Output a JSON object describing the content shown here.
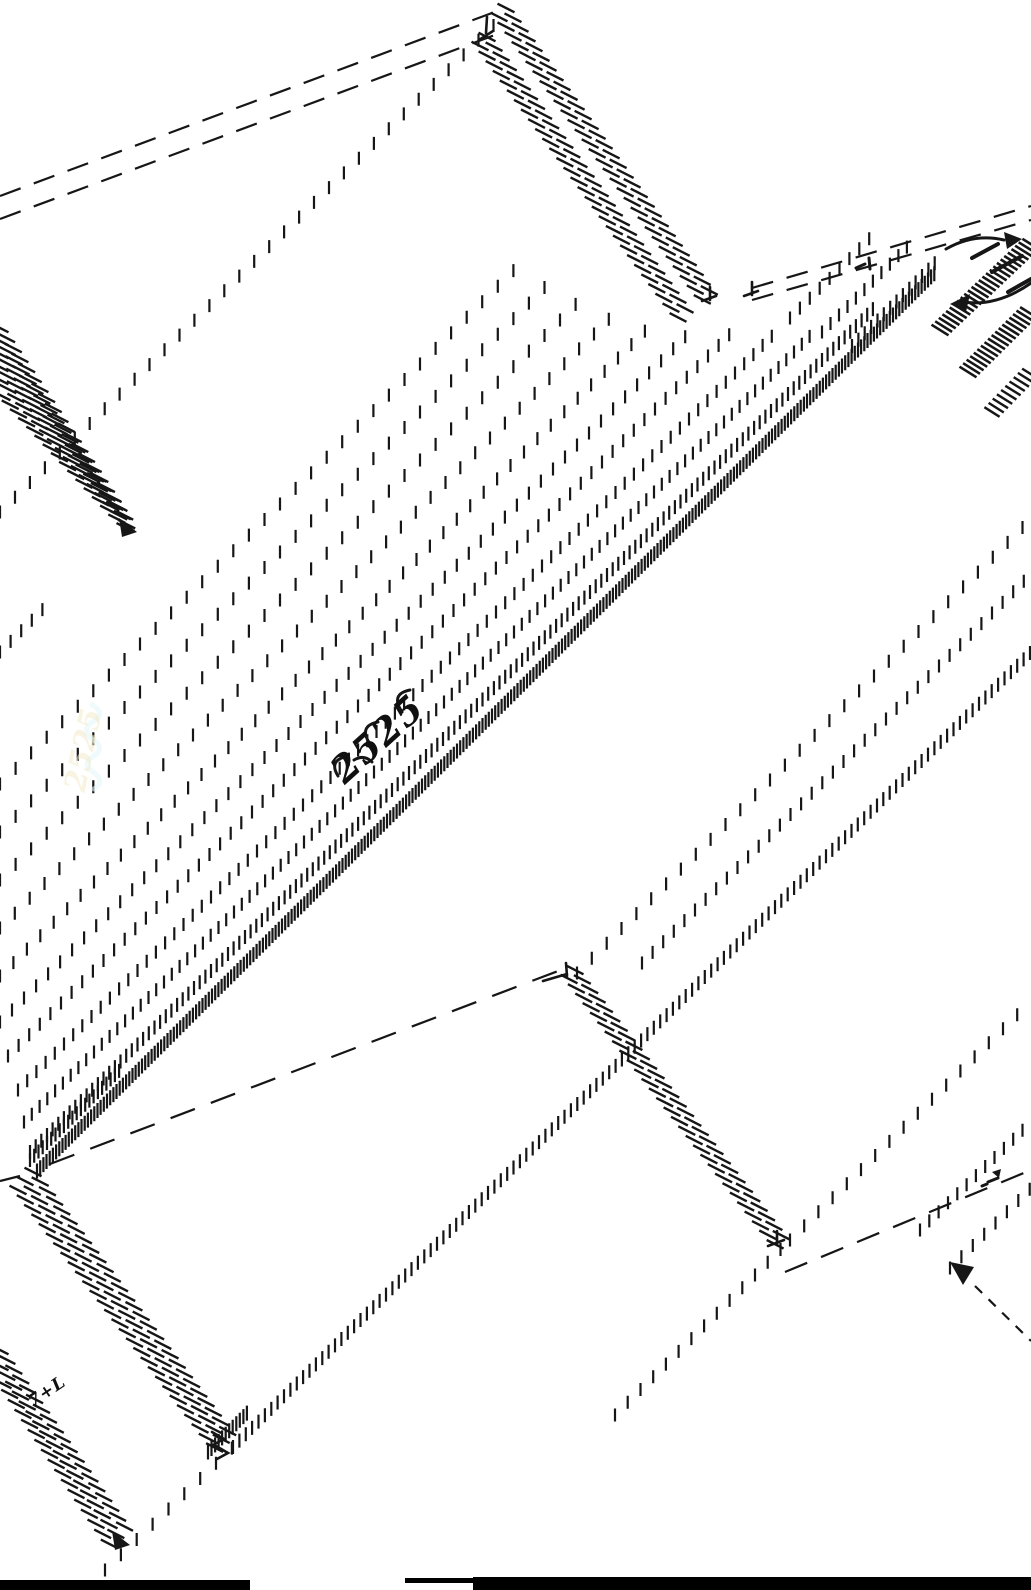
{
  "drawing": {
    "ink": "#161616",
    "background": "#ffffff",
    "canvas": {
      "width": 1031,
      "height": 1590
    },
    "annotations": [
      {
        "id": "center-scribble",
        "text": "2525",
        "x": 386,
        "y": 748,
        "rot": -42,
        "size": 37,
        "ls": 2,
        "color": "#101010",
        "opacity": 1
      },
      {
        "id": "bottom-left-scribble",
        "text": "7+L",
        "x": 50,
        "y": 1396,
        "rot": -34,
        "size": 17,
        "ls": 1,
        "color": "#101010",
        "opacity": 1
      },
      {
        "id": "ghost-scribble",
        "text": "2525",
        "x": 93,
        "y": 752,
        "rot": -78,
        "size": 30,
        "ls": 0,
        "color": "#f3ecca",
        "opacity": 0.55
      }
    ],
    "bars": [
      {
        "id": "bottom-left-bar",
        "x": 0,
        "y": 1580,
        "w": 250,
        "h": 10
      },
      {
        "id": "bottom-strip",
        "x": 405,
        "y": 1578,
        "w": 68,
        "h": 5
      },
      {
        "id": "bottom-right-bar",
        "x": 473,
        "y": 1577,
        "w": 558,
        "h": 13
      }
    ],
    "primitives": [
      {
        "t": "dash",
        "n": "roof-top-dash-a",
        "p": [
          0,
          196,
          500,
          10
        ],
        "da": [
          22,
          14
        ]
      },
      {
        "t": "dash",
        "n": "roof-top-dash-b",
        "p": [
          0,
          219,
          503,
          32
        ],
        "da": [
          22,
          14
        ]
      },
      {
        "t": "dash",
        "n": "wall-top-dash-a",
        "p": [
          752,
          288,
          1031,
          206
        ],
        "da": [
          22,
          14
        ]
      },
      {
        "t": "dash",
        "n": "wall-top-dash-b",
        "p": [
          752,
          300,
          1031,
          220
        ],
        "da": [
          22,
          14
        ]
      },
      {
        "t": "dash",
        "n": "valley-dash",
        "p": [
          50,
          1164,
          566,
          968
        ],
        "da": [
          26,
          17
        ]
      },
      {
        "t": "dash",
        "n": "bottom-right-dash",
        "p": [
          785,
          1272,
          1031,
          1170
        ],
        "da": [
          24,
          15
        ]
      },
      {
        "t": "dash",
        "n": "arrow-leader-dash",
        "p": [
          975,
          1286,
          1031,
          1341
        ],
        "da": [
          10,
          9
        ]
      },
      {
        "t": "solid",
        "n": "tip-left-line",
        "p": [
          0,
          1181,
          20,
          1176
        ]
      },
      {
        "t": "stair",
        "n": "ridge-band-a1",
        "p": [
          506,
          8,
          714,
          297
        ]
      },
      {
        "t": "stair",
        "n": "ridge-band-a2",
        "p": [
          499,
          17,
          707,
          306
        ]
      },
      {
        "t": "stair",
        "n": "ridge-band-b1",
        "p": [
          487,
          37,
          692,
          318
        ]
      },
      {
        "t": "stair",
        "n": "ridge-band-b2",
        "p": [
          480,
          46,
          685,
          327
        ]
      },
      {
        "t": "stair",
        "n": "left-edge-band-1",
        "p": [
          0,
          328,
          118,
          505
        ]
      },
      {
        "t": "stair",
        "n": "left-edge-band-2",
        "p": [
          0,
          341,
          122,
          511
        ]
      },
      {
        "t": "stair",
        "n": "left-edge-band-3",
        "p": [
          0,
          354,
          126,
          517
        ]
      },
      {
        "t": "stair",
        "n": "left-edge-band-4",
        "p": [
          0,
          367,
          129,
          523
        ]
      },
      {
        "t": "stair",
        "n": "left-edge-band-5",
        "p": [
          0,
          380,
          131,
          529
        ]
      },
      {
        "t": "stair",
        "n": "left-edge-band-6",
        "p": [
          2,
          396,
          133,
          536
        ]
      },
      {
        "t": "stair",
        "n": "tip-band-1",
        "p": [
          33,
          1172,
          233,
          1438
        ]
      },
      {
        "t": "stair",
        "n": "tip-band-2",
        "p": [
          25,
          1181,
          226,
          1445
        ]
      },
      {
        "t": "stair",
        "n": "tip-band-3",
        "p": [
          18,
          1190,
          218,
          1452
        ]
      },
      {
        "t": "stair",
        "n": "low-left-band-1",
        "p": [
          0,
          1350,
          127,
          1530
        ]
      },
      {
        "t": "stair",
        "n": "low-left-band-2",
        "p": [
          0,
          1366,
          120,
          1540
        ]
      },
      {
        "t": "stair",
        "n": "low-left-band-3",
        "p": [
          3,
          1384,
          112,
          1548
        ]
      },
      {
        "t": "stair",
        "n": "v-right-band-1",
        "p": [
          575,
          970,
          785,
          1240
        ]
      },
      {
        "t": "stair",
        "n": "v-right-band-2",
        "p": [
          569,
          979,
          778,
          1248
        ]
      },
      {
        "t": "stair",
        "n": "tr-hatch-1",
        "p": [
          940,
          330,
          1031,
          244
        ],
        "sp": 5,
        "len": 20,
        "a": 32,
        "w": 2.6
      },
      {
        "t": "stair",
        "n": "tr-hatch-2",
        "p": [
          968,
          372,
          1031,
          310
        ],
        "sp": 5,
        "len": 20,
        "a": 32,
        "w": 2.6
      },
      {
        "t": "stair",
        "n": "tr-hatch-3",
        "p": [
          992,
          412,
          1031,
          372
        ],
        "sp": 6,
        "len": 18,
        "a": 32,
        "w": 2.4
      },
      {
        "t": "ticks",
        "n": "tickrow-topleft",
        "p": [
          0,
          512,
          497,
          22
        ],
        "sp": 21
      },
      {
        "t": "ticks",
        "n": "tickrow-left-frag",
        "p": [
          0,
          652,
          46,
          606
        ],
        "sp": 15
      },
      {
        "t": "ticks",
        "n": "tickrow-central-a",
        "p": [
          0,
          784,
          522,
          262
        ],
        "sp": 22
      },
      {
        "t": "ticks",
        "n": "tickrow-central-b",
        "p": [
          0,
          832,
          556,
          276
        ],
        "sp": 22
      },
      {
        "t": "ticks",
        "n": "tickrow-central-1",
        "p": [
          0,
          880,
          588,
          292
        ],
        "sp": 22
      },
      {
        "t": "ticks",
        "n": "tickrow-central-2",
        "p": [
          0,
          928,
          622,
          306
        ],
        "sp": 21
      },
      {
        "t": "ticks",
        "n": "tickrow-central-3",
        "p": [
          0,
          976,
          658,
          318
        ],
        "sp": 19
      },
      {
        "t": "ticks",
        "n": "tickrow-central-4",
        "p": [
          0,
          1022,
          694,
          328
        ],
        "sp": 17
      },
      {
        "t": "ticks",
        "n": "tickrow-central-5",
        "p": [
          8,
          1056,
          730,
          334
        ],
        "sp": 15
      },
      {
        "t": "ticks",
        "n": "tickrow-central-6",
        "p": [
          18,
          1090,
          772,
          336
        ],
        "sp": 13
      },
      {
        "t": "ticks",
        "n": "tickrow-central-7",
        "p": [
          24,
          1122,
          812,
          334
        ],
        "sp": 11
      },
      {
        "t": "ticks",
        "n": "tickrow-central-8",
        "p": [
          30,
          1152,
          874,
          308
        ],
        "sp": 8,
        "len": 14
      },
      {
        "t": "ticks",
        "n": "tickrow-central-9",
        "p": [
          37,
          1171,
          936,
          272
        ],
        "sp": 4.5,
        "len": 15
      },
      {
        "t": "ticks",
        "n": "tickrow-tip-cluster",
        "p": [
          30,
          1160,
          120,
          1070
        ],
        "sp": 6,
        "len": 14
      },
      {
        "t": "ticks",
        "n": "tickrow-wall-1",
        "p": [
          790,
          318,
          874,
          234
        ],
        "sp": 14
      },
      {
        "t": "ticks",
        "n": "tickrow-wall-2",
        "p": [
          822,
          332,
          908,
          246
        ],
        "sp": 12
      },
      {
        "t": "ticks",
        "n": "tickrow-wall-3",
        "p": [
          852,
          346,
          940,
          258
        ],
        "sp": 9,
        "len": 14
      },
      {
        "t": "ticks",
        "n": "tickrow-right-1",
        "p": [
          577,
          973,
          1031,
          519
        ],
        "sp": 21
      },
      {
        "t": "ticks",
        "n": "tickrow-right-2",
        "p": [
          642,
          963,
          1031,
          574
        ],
        "sp": 15
      },
      {
        "t": "ticks",
        "n": "tickrow-low-a",
        "p": [
          105,
          1570,
          233,
          1447
        ],
        "sp": 22
      },
      {
        "t": "ticks",
        "n": "tickrow-low-b",
        "p": [
          233,
          1447,
          1031,
          652
        ],
        "sp": 9,
        "len": 14
      },
      {
        "t": "ticks",
        "n": "tickrow-corner-cluster",
        "p": [
          208,
          1452,
          250,
          1410
        ],
        "sp": 5,
        "len": 15
      },
      {
        "t": "ticks",
        "n": "tickrow-br-1",
        "p": [
          790,
          1240,
          1031,
          1001
        ],
        "sp": 20
      },
      {
        "t": "ticks",
        "n": "tickrow-br-2",
        "p": [
          920,
          1230,
          1031,
          1122
        ],
        "sp": 13
      },
      {
        "t": "ticks",
        "n": "tickrow-br-3",
        "p": [
          950,
          1268,
          1031,
          1188
        ],
        "sp": 16
      },
      {
        "t": "ticks",
        "n": "tickrow-br-4",
        "p": [
          615,
          1415,
          786,
          1244
        ],
        "sp": 18
      },
      {
        "t": "path",
        "n": "apex-corner-mark",
        "d": "M479,40 l14,-9 m-6,-14 l-1,16"
      },
      {
        "t": "path",
        "n": "ridge-end-mark-a",
        "d": "M702,301 l14,-5 m-6,-9 l0,13"
      },
      {
        "t": "path",
        "n": "ridge-end-mark-b",
        "d": "M744,296 l14,-5 m-6,-9 l0,13"
      },
      {
        "t": "path",
        "n": "valley-top-corner",
        "d": "M543,981 l24,-7 m-1,-11 l1,13"
      },
      {
        "t": "path",
        "n": "valley-bottom-corner",
        "d": "M768,1246 l16,-6 m-7,-9 l0,14"
      },
      {
        "t": "path",
        "n": "down-chevrons",
        "d": "M212,1432 l12,7 l-11,6 M216,1446 l12,7 l-11,6"
      },
      {
        "t": "path",
        "n": "tr-small-mark",
        "d": "M856,268 l9,-4 m4,-6 l1,11",
        "w": 3
      },
      {
        "t": "path",
        "n": "br-small-mark",
        "d": "M988,1182 l10,-4 m-16,8 l5,-2",
        "w": 3
      },
      {
        "t": "path",
        "n": "br-small-blob",
        "d": "M992,1172 l9,-3 l-2,9 z",
        "fill": true
      },
      {
        "t": "path",
        "n": "tr-arrow-right-shaft",
        "d": "M946,249 q28,-16 58,-9",
        "w": 3
      },
      {
        "t": "path",
        "n": "tr-arrow-right-head",
        "d": "M1004,232 l18,7 l-15,10 z",
        "fill": true
      },
      {
        "t": "path",
        "n": "tr-arrow-left-shaft",
        "d": "M1031,283 q-34,24 -68,19",
        "w": 3
      },
      {
        "t": "path",
        "n": "tr-arrow-left-head",
        "d": "M950,304 l20,-10 l-4,18 z",
        "fill": true
      },
      {
        "t": "path",
        "n": "tr-heavy-strokes",
        "d": "M972,258 l26,-14 M992,272 l30,-16 M1008,292 l23,-13",
        "w": 4
      },
      {
        "t": "path",
        "n": "left-band-arrowhead",
        "d": "M137,532 L119,518 L122,537 Z",
        "fill": true
      },
      {
        "t": "path",
        "n": "low-left-arrowhead",
        "d": "M130,1545 L112,1531 L115,1550 Z",
        "fill": true
      },
      {
        "t": "path",
        "n": "br-arrowhead",
        "d": "M950,1262 L974,1267 L963,1285 Z",
        "fill": true
      },
      {
        "t": "path",
        "n": "center-scribble-loops",
        "d": "M338,776 q-10,-16 10,-20 M370,744 q-12,-18 8,-22 M402,712 q-12,-18 8,-22 M354,760 q10,-6 18,2",
        "w": 3
      },
      {
        "t": "path",
        "n": "ghost-scribble-loops",
        "d": "M92,705 q14,8 2,16 q-14,8 -2,18 q14,9 2,17 q-13,8 -1,16 q13,9 1,17",
        "w": 5,
        "color": "#e3f6f8",
        "opacity": 0.6
      }
    ]
  }
}
